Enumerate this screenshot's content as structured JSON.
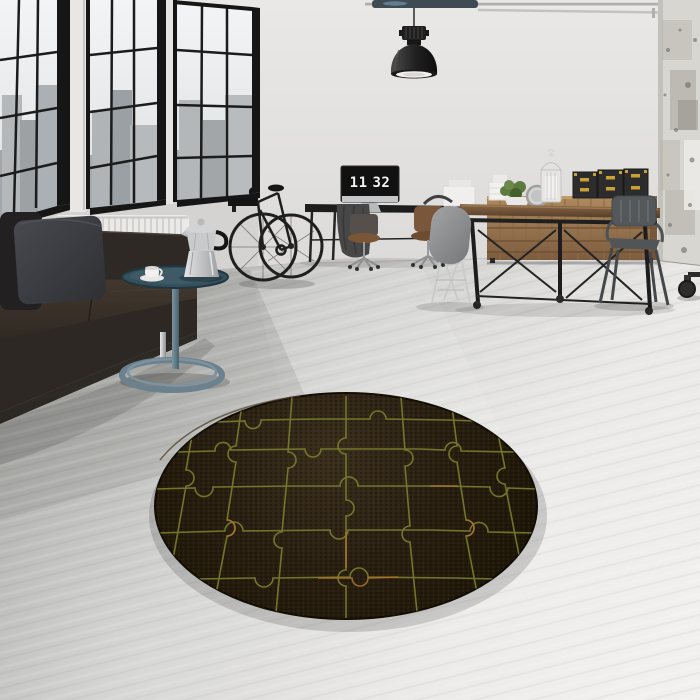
{
  "scene": {
    "description": "Industrial loft interior product photo: round dark jigsaw-puzzle rug on polished concrete floor",
    "clock": {
      "hours": "11",
      "minutes": "32"
    },
    "objects": {
      "rug": "round dark brown rug with olive jigsaw puzzle pattern",
      "sofa": "dark brown leather sofa with charcoal pillows",
      "side_table": "slate loop side table with moka pot and espresso cup",
      "bicycle": "black bicycle on wall rack",
      "desk": "black office desk with monitor showing flip clock",
      "dining_table": "industrial wood dining table on casters",
      "cabinet": "wooden drawer sideboard",
      "boxes": "black storage cases with brass fittings",
      "lantern": "white decorative lantern",
      "plant": "green potted plant",
      "mirror": "round table mirror",
      "pendant_lamp": "black industrial pendant lamp",
      "windows": "black-framed factory windows with city view",
      "radiator": "white wall radiator",
      "column": "distressed concrete column",
      "chairs": "gray shell chair, wooden office chairs, gunmetal metal armchair"
    }
  },
  "palette": {
    "wall": "#e4e3e1",
    "floor_light": "#f1f0ee",
    "floor_dark": "#9e9e9c",
    "window_frame": "#161616",
    "glass": "#eef0f1",
    "city": "#a8acaf",
    "sofa": "#2e2824",
    "pillow": "#3f4044",
    "radiator": "#ebeae8",
    "side_table": "#5f7682",
    "steel": "#c9cacc",
    "rug_base": "#251c10",
    "rug_line": "#777b2e",
    "rug_accent": "#b0742e",
    "wood": "#6e5138",
    "cabinet": "#a9825a",
    "box": "#2c2c2c",
    "brass": "#c9a136",
    "plant": "#5d7a3f",
    "chair": "#8f9092",
    "metal_chair": "#54585a",
    "lamp": "#1c1c1c",
    "column": "#d8d6d1",
    "pipe": "#b0b1af"
  }
}
